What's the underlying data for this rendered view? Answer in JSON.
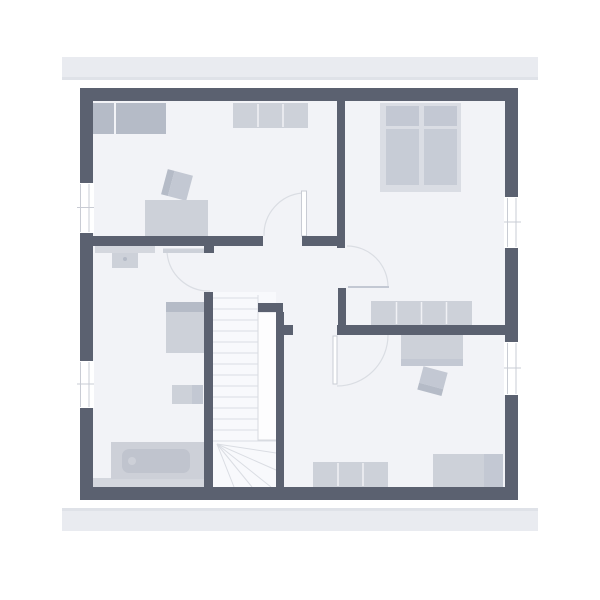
{
  "canvas": {
    "width": 600,
    "height": 600
  },
  "colors": {
    "bg": "#ffffff",
    "eave": "#e9ebf0",
    "eaveEdge": "#dfe2e8",
    "wall": "#5b6170",
    "floor": "#f2f3f7",
    "stairFloor": "#f8f9fc",
    "voidFill": "#fdfdfe",
    "voidLine": "#d6d9df",
    "white": "#ffffff",
    "furnLight": "#cdd1d9",
    "furnMed": "#c3c8d3",
    "furnMed2": "#c7ccd6",
    "furnDark": "#b5bbc7",
    "bedBase": "#dadde4",
    "strip": "#d4d7de",
    "tubRim": "#cdd0d8",
    "tubFill": "#c0c4ce",
    "line": "#dadde3",
    "winLine": "#c9ccd4",
    "divider": "#f0f1f5"
  },
  "plan": {
    "elements": [
      {
        "name": "roof-eave-top",
        "type": "rect",
        "x": 62,
        "y": 57,
        "w": 476,
        "h": 23,
        "fill": "eave"
      },
      {
        "name": "roof-eave-top-shadow",
        "type": "rect",
        "x": 62,
        "y": 77,
        "w": 476,
        "h": 3,
        "fill": "eaveEdge"
      },
      {
        "name": "roof-eave-bottom",
        "type": "rect",
        "x": 62,
        "y": 508,
        "w": 476,
        "h": 23,
        "fill": "eave"
      },
      {
        "name": "roof-eave-bottom-shadow",
        "type": "rect",
        "x": 62,
        "y": 508,
        "w": 476,
        "h": 3,
        "fill": "eaveEdge"
      },
      {
        "name": "floor-area",
        "type": "rect",
        "x": 80,
        "y": 88,
        "w": 438,
        "h": 412,
        "fill": "floor"
      },
      {
        "name": "stair-floor",
        "type": "rect",
        "x": 213,
        "y": 292,
        "w": 63,
        "h": 195,
        "fill": "stairFloor"
      },
      {
        "name": "bathroom-floor-strip",
        "type": "rect",
        "x": 93,
        "y": 478,
        "w": 120,
        "h": 9,
        "fill": "strip"
      },
      {
        "name": "wardrobe-left-section",
        "type": "rect",
        "x": 93,
        "y": 103,
        "w": 21,
        "h": 31,
        "fill": "furnDark"
      },
      {
        "name": "wardrobe-right-section",
        "type": "rect",
        "x": 116,
        "y": 103,
        "w": 50,
        "h": 31,
        "fill": "furnDark"
      },
      {
        "name": "dresser-top",
        "type": "rect",
        "x": 233,
        "y": 103,
        "w": 75,
        "h": 25,
        "fill": "furnLight"
      },
      {
        "name": "dresser-top-divider",
        "type": "line",
        "x1": 258,
        "y1": 104,
        "x2": 258,
        "y2": 127,
        "stroke": "divider",
        "sw": 1.5
      },
      {
        "name": "dresser-top-divider",
        "type": "line",
        "x1": 283,
        "y1": 104,
        "x2": 283,
        "y2": 127,
        "stroke": "divider",
        "sw": 1.5
      },
      {
        "name": "desk-chair-back",
        "type": "rect",
        "x": 164,
        "y": 172,
        "w": 7,
        "h": 26,
        "fill": "furnDark",
        "rot": "15 177 185"
      },
      {
        "name": "desk-chair-seat",
        "type": "rect",
        "x": 171,
        "y": 172,
        "w": 19,
        "h": 26,
        "fill": "furnMed",
        "rot": "15 177 185"
      },
      {
        "name": "desk",
        "type": "rect",
        "x": 145,
        "y": 200,
        "w": 63,
        "h": 37,
        "fill": "furnLight"
      },
      {
        "name": "bed-base",
        "type": "rect",
        "x": 380,
        "y": 103,
        "w": 81,
        "h": 89,
        "fill": "bedBase"
      },
      {
        "name": "bed-pillow-left",
        "type": "rect",
        "x": 386,
        "y": 106,
        "w": 33,
        "h": 20,
        "fill": "furnMed"
      },
      {
        "name": "bed-pillow-right",
        "type": "rect",
        "x": 424,
        "y": 106,
        "w": 33,
        "h": 20,
        "fill": "furnMed"
      },
      {
        "name": "bed-mattress-left",
        "type": "rect",
        "x": 386,
        "y": 129,
        "w": 33,
        "h": 56,
        "fill": "furnMed2"
      },
      {
        "name": "bed-mattress-right",
        "type": "rect",
        "x": 424,
        "y": 129,
        "w": 33,
        "h": 56,
        "fill": "furnMed2"
      },
      {
        "name": "bedroom-sideboard",
        "type": "rect",
        "x": 371,
        "y": 301,
        "w": 101,
        "h": 24,
        "fill": "furnLight"
      },
      {
        "name": "bedroom-sideboard-divider",
        "type": "line",
        "x1": 396.5,
        "y1": 302,
        "x2": 396.5,
        "y2": 324,
        "stroke": "divider",
        "sw": 1.5
      },
      {
        "name": "bedroom-sideboard-divider",
        "type": "line",
        "x1": 421.5,
        "y1": 302,
        "x2": 421.5,
        "y2": 324,
        "stroke": "divider",
        "sw": 1.5
      },
      {
        "name": "bedroom-sideboard-divider",
        "type": "line",
        "x1": 446.5,
        "y1": 302,
        "x2": 446.5,
        "y2": 324,
        "stroke": "divider",
        "sw": 1.5
      },
      {
        "name": "bath-counter",
        "type": "rect",
        "x": 95,
        "y": 245,
        "w": 60,
        "h": 8,
        "fill": "strip"
      },
      {
        "name": "washbasin",
        "type": "rect",
        "x": 112,
        "y": 253,
        "w": 26,
        "h": 15,
        "fill": "furnLight"
      },
      {
        "name": "washbasin-drain",
        "type": "circle",
        "cx": 125,
        "cy": 259,
        "r": 2,
        "fill": "furnDark"
      },
      {
        "name": "shower-top",
        "type": "rect",
        "x": 166,
        "y": 302,
        "w": 38,
        "h": 10,
        "fill": "furnDark"
      },
      {
        "name": "shower-body",
        "type": "rect",
        "x": 166,
        "y": 312,
        "w": 38,
        "h": 41,
        "fill": "furnLight"
      },
      {
        "name": "wc-body",
        "type": "rect",
        "x": 172,
        "y": 385,
        "w": 20,
        "h": 19,
        "fill": "furnLight"
      },
      {
        "name": "wc-cistern",
        "type": "rect",
        "x": 192,
        "y": 385,
        "w": 11,
        "h": 19,
        "fill": "furnMed"
      },
      {
        "name": "bathtub-rim",
        "type": "rect",
        "x": 111,
        "y": 442,
        "w": 93,
        "h": 37,
        "fill": "tubRim"
      },
      {
        "name": "bathtub-basin",
        "type": "rect",
        "x": 122,
        "y": 449,
        "w": 68,
        "h": 24,
        "rx": 7,
        "fill": "tubFill"
      },
      {
        "name": "bathtub-drain",
        "type": "circle",
        "cx": 132,
        "cy": 461,
        "r": 4,
        "fill": "tubRim"
      },
      {
        "name": "desk-bottom-room",
        "type": "rect",
        "x": 401,
        "y": 334,
        "w": 62,
        "h": 25,
        "fill": "furnLight"
      },
      {
        "name": "desk-bottom-room-edge",
        "type": "rect",
        "x": 401,
        "y": 359,
        "w": 62,
        "h": 7,
        "fill": "furnMed"
      },
      {
        "name": "chair-bottom-seat",
        "type": "rect",
        "x": 420,
        "y": 369,
        "w": 25,
        "h": 17,
        "fill": "furnMed",
        "rot": "15 432 381"
      },
      {
        "name": "chair-bottom-back",
        "type": "rect",
        "x": 420,
        "y": 386,
        "w": 25,
        "h": 7,
        "fill": "furnDark",
        "rot": "15 432 381"
      },
      {
        "name": "dresser-bottom",
        "type": "rect",
        "x": 313,
        "y": 462,
        "w": 75,
        "h": 25,
        "fill": "furnLight"
      },
      {
        "name": "dresser-bottom-divider",
        "type": "line",
        "x1": 338,
        "y1": 463,
        "x2": 338,
        "y2": 486,
        "stroke": "divider",
        "sw": 1.5
      },
      {
        "name": "dresser-bottom-divider",
        "type": "line",
        "x1": 363,
        "y1": 463,
        "x2": 363,
        "y2": 486,
        "stroke": "divider",
        "sw": 1.5
      },
      {
        "name": "wardrobe-bottom-right",
        "type": "rect",
        "x": 433,
        "y": 454,
        "w": 51,
        "h": 33,
        "fill": "furnLight"
      },
      {
        "name": "cabinet-bottom-right",
        "type": "rect",
        "x": 484,
        "y": 454,
        "w": 19,
        "h": 33,
        "fill": "furnMed"
      },
      {
        "name": "stair-void",
        "type": "rect",
        "x": 258,
        "y": 312,
        "w": 19,
        "h": 128,
        "fill": "voidFill",
        "stroke": "voidLine",
        "sw": 1
      },
      {
        "name": "stair-tread",
        "type": "line",
        "x1": 213,
        "y1": 298,
        "x2": 258,
        "y2": 298,
        "stroke": "line",
        "sw": 1
      },
      {
        "name": "stair-tread",
        "type": "line",
        "x1": 213,
        "y1": 309,
        "x2": 258,
        "y2": 309,
        "stroke": "line",
        "sw": 1
      },
      {
        "name": "stair-tread",
        "type": "line",
        "x1": 213,
        "y1": 320,
        "x2": 258,
        "y2": 320,
        "stroke": "line",
        "sw": 1
      },
      {
        "name": "stair-tread",
        "type": "line",
        "x1": 213,
        "y1": 331,
        "x2": 258,
        "y2": 331,
        "stroke": "line",
        "sw": 1
      },
      {
        "name": "stair-tread",
        "type": "line",
        "x1": 213,
        "y1": 342,
        "x2": 258,
        "y2": 342,
        "stroke": "line",
        "sw": 1
      },
      {
        "name": "stair-tread",
        "type": "line",
        "x1": 213,
        "y1": 353,
        "x2": 258,
        "y2": 353,
        "stroke": "line",
        "sw": 1
      },
      {
        "name": "stair-tread",
        "type": "line",
        "x1": 213,
        "y1": 364,
        "x2": 258,
        "y2": 364,
        "stroke": "line",
        "sw": 1
      },
      {
        "name": "stair-tread",
        "type": "line",
        "x1": 213,
        "y1": 375,
        "x2": 258,
        "y2": 375,
        "stroke": "line",
        "sw": 1
      },
      {
        "name": "stair-tread",
        "type": "line",
        "x1": 213,
        "y1": 386,
        "x2": 258,
        "y2": 386,
        "stroke": "line",
        "sw": 1
      },
      {
        "name": "stair-tread",
        "type": "line",
        "x1": 213,
        "y1": 397,
        "x2": 258,
        "y2": 397,
        "stroke": "line",
        "sw": 1
      },
      {
        "name": "stair-tread",
        "type": "line",
        "x1": 213,
        "y1": 408,
        "x2": 258,
        "y2": 408,
        "stroke": "line",
        "sw": 1
      },
      {
        "name": "stair-tread",
        "type": "line",
        "x1": 213,
        "y1": 419,
        "x2": 258,
        "y2": 419,
        "stroke": "line",
        "sw": 1
      },
      {
        "name": "stair-tread",
        "type": "line",
        "x1": 213,
        "y1": 430,
        "x2": 258,
        "y2": 430,
        "stroke": "line",
        "sw": 1
      },
      {
        "name": "stair-tread-full",
        "type": "line",
        "x1": 213,
        "y1": 441,
        "x2": 276,
        "y2": 441,
        "stroke": "line",
        "sw": 1
      },
      {
        "name": "stair-tread-edge",
        "type": "line",
        "x1": 258,
        "y1": 295,
        "x2": 258,
        "y2": 312,
        "stroke": "line",
        "sw": 1
      },
      {
        "name": "stair-winder",
        "type": "line",
        "x1": 217,
        "y1": 444,
        "x2": 276,
        "y2": 453,
        "stroke": "line",
        "sw": 1
      },
      {
        "name": "stair-winder",
        "type": "line",
        "x1": 217,
        "y1": 444,
        "x2": 276,
        "y2": 470,
        "stroke": "line",
        "sw": 1
      },
      {
        "name": "stair-winder",
        "type": "line",
        "x1": 217,
        "y1": 444,
        "x2": 271,
        "y2": 487,
        "stroke": "line",
        "sw": 1
      },
      {
        "name": "stair-winder",
        "type": "line",
        "x1": 217,
        "y1": 444,
        "x2": 252,
        "y2": 487,
        "stroke": "line",
        "sw": 1
      },
      {
        "name": "stair-winder",
        "type": "line",
        "x1": 217,
        "y1": 444,
        "x2": 234,
        "y2": 487,
        "stroke": "line",
        "sw": 1
      },
      {
        "name": "door-arc-top-left-room",
        "type": "path",
        "d": "M302,193 A42,42 0 0 0 264,236",
        "stroke": "line",
        "sw": 1.2
      },
      {
        "name": "door-leaf-top-left-room",
        "type": "rect",
        "x": 301.5,
        "y": 191,
        "w": 5,
        "h": 45,
        "fill": "white",
        "stroke": "winLine",
        "sw": 1
      },
      {
        "name": "door-arc-bedroom",
        "type": "path",
        "d": "M347,246 A41,41 0 0 1 388,287",
        "stroke": "line",
        "sw": 1.2
      },
      {
        "name": "door-leaf-bedroom",
        "type": "line",
        "x1": 348,
        "y1": 287,
        "x2": 389,
        "y2": 287,
        "stroke": "furnMed",
        "sw": 2
      },
      {
        "name": "door-arc-bathroom",
        "type": "path",
        "d": "M167,252 A42,42 0 0 0 210,291",
        "stroke": "line",
        "sw": 1.2
      },
      {
        "name": "door-leaf-bathroom",
        "type": "rect",
        "x": 163,
        "y": 248.5,
        "w": 46,
        "h": 4.5,
        "fill": "furnLight"
      },
      {
        "name": "door-arc-bottom-room",
        "type": "path",
        "d": "M388,335 A51,51 0 0 1 337,386",
        "stroke": "line",
        "sw": 1.2
      },
      {
        "name": "door-leaf-bottom-room",
        "type": "rect",
        "x": 333,
        "y": 336,
        "w": 4,
        "h": 48,
        "fill": "white",
        "stroke": "winLine",
        "sw": 1
      },
      {
        "name": "wall-exterior-top",
        "type": "rect",
        "x": 80,
        "y": 88,
        "w": 438,
        "h": 13,
        "fill": "wall"
      },
      {
        "name": "wall-exterior-left",
        "type": "rect",
        "x": 80,
        "y": 88,
        "w": 13,
        "h": 412,
        "fill": "wall"
      },
      {
        "name": "wall-exterior-right",
        "type": "rect",
        "x": 505,
        "y": 88,
        "w": 13,
        "h": 412,
        "fill": "wall"
      },
      {
        "name": "wall-exterior-bottom",
        "type": "rect",
        "x": 80,
        "y": 487,
        "w": 438,
        "h": 13,
        "fill": "wall"
      },
      {
        "name": "wall-hall-north",
        "type": "rect",
        "x": 83,
        "y": 236,
        "w": 180,
        "h": 10,
        "fill": "wall"
      },
      {
        "name": "wall-hall-north-east",
        "type": "rect",
        "x": 302,
        "y": 236,
        "w": 43,
        "h": 10,
        "fill": "wall"
      },
      {
        "name": "wall-top-rooms-divider",
        "type": "rect",
        "x": 337,
        "y": 101,
        "w": 8,
        "h": 147,
        "fill": "wall"
      },
      {
        "name": "wall-bedroom-west",
        "type": "rect",
        "x": 338,
        "y": 288,
        "w": 8,
        "h": 37,
        "fill": "wall"
      },
      {
        "name": "wall-bedroom-south",
        "type": "rect",
        "x": 337,
        "y": 325,
        "w": 181,
        "h": 10,
        "fill": "wall"
      },
      {
        "name": "wall-door-chunk",
        "type": "rect",
        "x": 283,
        "y": 325,
        "w": 10,
        "h": 10,
        "fill": "wall"
      },
      {
        "name": "wall-stair-west",
        "type": "rect",
        "x": 204,
        "y": 292,
        "w": 9,
        "h": 195,
        "fill": "wall"
      },
      {
        "name": "wall-bath-door-stub",
        "type": "rect",
        "x": 204,
        "y": 245,
        "w": 10,
        "h": 8,
        "fill": "wall"
      },
      {
        "name": "wall-stair-east",
        "type": "rect",
        "x": 276,
        "y": 312,
        "w": 8,
        "h": 175,
        "fill": "wall"
      },
      {
        "name": "wall-stair-cap",
        "type": "rect",
        "x": 258,
        "y": 303,
        "w": 25,
        "h": 9,
        "fill": "wall"
      },
      {
        "name": "window-left-upper",
        "type": "rect",
        "x": 77,
        "y": 183,
        "w": 17,
        "h": 50,
        "fill": "white"
      },
      {
        "name": "window-left-upper-frame",
        "type": "line",
        "x1": 80.5,
        "y1": 184,
        "x2": 80.5,
        "y2": 232,
        "stroke": "winLine",
        "sw": 1
      },
      {
        "name": "window-left-upper-frame",
        "type": "line",
        "x1": 89,
        "y1": 184,
        "x2": 89,
        "y2": 232,
        "stroke": "winLine",
        "sw": 1
      },
      {
        "name": "window-left-upper-frame",
        "type": "line",
        "x1": 77,
        "y1": 207.5,
        "x2": 94,
        "y2": 207.5,
        "stroke": "winLine",
        "sw": 1
      },
      {
        "name": "window-left-lower",
        "type": "rect",
        "x": 77,
        "y": 361,
        "w": 17,
        "h": 47,
        "fill": "white"
      },
      {
        "name": "window-left-lower-frame",
        "type": "line",
        "x1": 80.5,
        "y1": 362,
        "x2": 80.5,
        "y2": 407,
        "stroke": "winLine",
        "sw": 1
      },
      {
        "name": "window-left-lower-frame",
        "type": "line",
        "x1": 89,
        "y1": 362,
        "x2": 89,
        "y2": 407,
        "stroke": "winLine",
        "sw": 1
      },
      {
        "name": "window-left-lower-frame",
        "type": "line",
        "x1": 77,
        "y1": 384,
        "x2": 94,
        "y2": 384,
        "stroke": "winLine",
        "sw": 1
      },
      {
        "name": "window-right-upper",
        "type": "rect",
        "x": 504,
        "y": 197,
        "w": 17,
        "h": 51,
        "fill": "white"
      },
      {
        "name": "window-right-upper-frame",
        "type": "line",
        "x1": 507.5,
        "y1": 198,
        "x2": 507.5,
        "y2": 247,
        "stroke": "winLine",
        "sw": 1
      },
      {
        "name": "window-right-upper-frame",
        "type": "line",
        "x1": 516,
        "y1": 198,
        "x2": 516,
        "y2": 247,
        "stroke": "winLine",
        "sw": 1
      },
      {
        "name": "window-right-upper-frame",
        "type": "line",
        "x1": 504,
        "y1": 222,
        "x2": 521,
        "y2": 222,
        "stroke": "winLine",
        "sw": 1
      },
      {
        "name": "window-right-lower",
        "type": "rect",
        "x": 504,
        "y": 342,
        "w": 17,
        "h": 53,
        "fill": "white"
      },
      {
        "name": "window-right-lower-frame",
        "type": "line",
        "x1": 507.5,
        "y1": 343,
        "x2": 507.5,
        "y2": 394,
        "stroke": "winLine",
        "sw": 1
      },
      {
        "name": "window-right-lower-frame",
        "type": "line",
        "x1": 516,
        "y1": 343,
        "x2": 516,
        "y2": 394,
        "stroke": "winLine",
        "sw": 1
      },
      {
        "name": "window-right-lower-frame",
        "type": "line",
        "x1": 504,
        "y1": 368,
        "x2": 521,
        "y2": 368,
        "stroke": "winLine",
        "sw": 1
      }
    ]
  }
}
